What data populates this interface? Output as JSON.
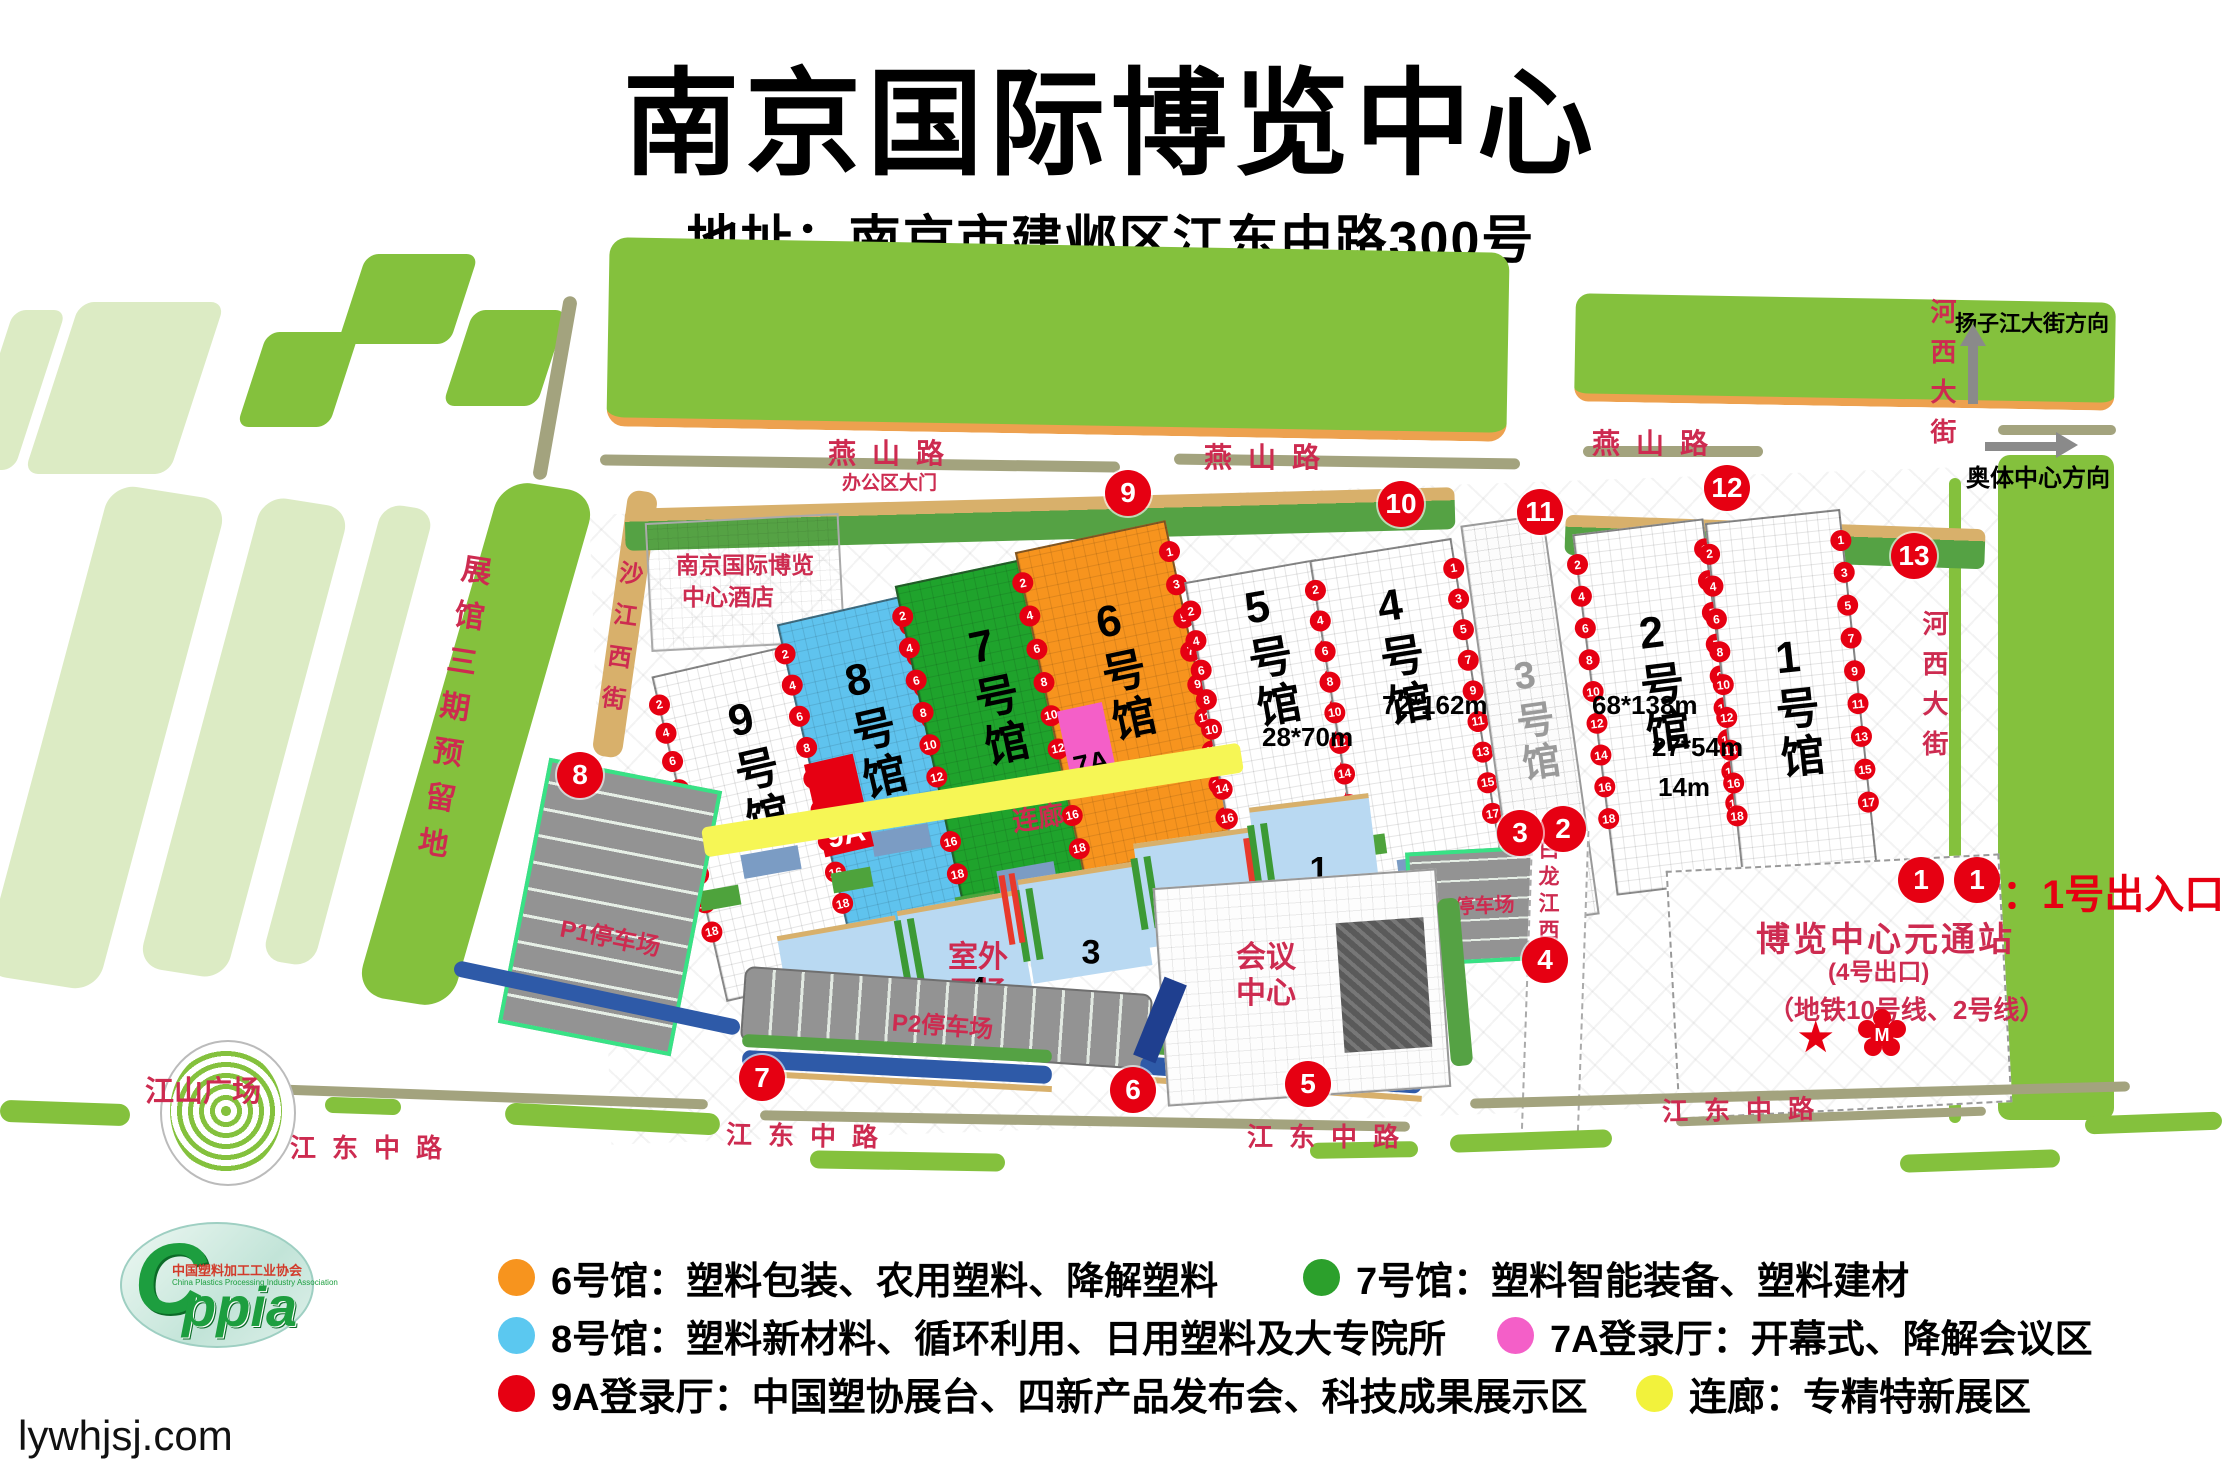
{
  "header": {
    "title": "南京国际博览中心",
    "address": "地址：南京市建邺区江东中路300号"
  },
  "watermark": "lywhjsj.com",
  "roads": {
    "yanshan": "燕山路",
    "jiangdong": "江东中路",
    "jinsha": "金沙江西街",
    "bailong": "白龙江西街",
    "hexi": "河西大街"
  },
  "directions": {
    "yangzijiang": "扬子江大街方向",
    "aoti": "奥体中心方向"
  },
  "places": {
    "reserved_strip": "展馆三期预留地",
    "hotel_line1": "南京国际博览",
    "hotel_line2": "中心酒店",
    "office_gate": "办公区大门",
    "jiangshan_square": "江山广场",
    "outdoor_line1": "室外",
    "outdoor_line2": "展场",
    "conference_line1": "会议",
    "conference_line2": "中心",
    "corridor": "连廊",
    "p1": "P1停车场",
    "p2": "P2停车场",
    "p3": "P3停车场",
    "station_name": "博览中心元通站",
    "station_exit": "(4号出口)",
    "station_lines": "（地铁10号线、2号线）",
    "entrance_marker": "1",
    "entrance_note": "：1号出入口"
  },
  "halls": [
    {
      "id": "9",
      "label": "9号馆",
      "color": "#ffffff"
    },
    {
      "id": "8",
      "label": "8号馆",
      "color": "#5fc3ee"
    },
    {
      "id": "7",
      "label": "7号馆",
      "color": "#1fa32c"
    },
    {
      "id": "6",
      "label": "6号馆",
      "color": "#f7941e"
    },
    {
      "id": "5",
      "label": "5号馆",
      "color": "#ffffff"
    },
    {
      "id": "4",
      "label": "4号馆",
      "color": "#ffffff"
    },
    {
      "id": "3",
      "label": "3号馆",
      "color": "#ffffff"
    },
    {
      "id": "2",
      "label": "2号馆",
      "color": "#ffffff"
    },
    {
      "id": "1",
      "label": "1号馆",
      "color": "#ffffff"
    },
    {
      "id": "9A",
      "label": "9A",
      "color": "#e60012"
    },
    {
      "id": "7A",
      "label": "7A",
      "color": "#f45fc8"
    }
  ],
  "dims": {
    "hall4": "72*162m",
    "hall5": "28*70m",
    "hall2": "68*138m",
    "hall1": "27*54m",
    "hall1b": "14m"
  },
  "outdoor_numbers": [
    "1",
    "2",
    "3",
    "4",
    "5"
  ],
  "markers": [
    "1",
    "2",
    "3",
    "4",
    "5",
    "6",
    "7",
    "8",
    "9",
    "10",
    "11",
    "12",
    "13"
  ],
  "gate_numbers": {
    "left": [
      "2",
      "4",
      "6",
      "8",
      "10",
      "12",
      "14",
      "16",
      "18"
    ],
    "right": [
      "1",
      "3",
      "5",
      "7",
      "9",
      "11",
      "13",
      "15",
      "17"
    ]
  },
  "legend": [
    {
      "color": "#f7941e",
      "text": "6号馆：塑料包装、农用塑料、降解塑料"
    },
    {
      "color": "#2ca02c",
      "text": "7号馆：塑料智能装备、塑料建材"
    },
    {
      "color": "#5bc8f0",
      "text": "8号馆：塑料新材料、循环利用、日用塑料及大专院所"
    },
    {
      "color": "#f45fc8",
      "text": "7A登录厅：开幕式、降解会议区"
    },
    {
      "color": "#e60012",
      "text": "9A登录厅：中国塑协展台、四新产品发布会、科技成果展示区"
    },
    {
      "color": "#f2f23c",
      "text": "连廊：专精特新展区"
    }
  ],
  "logo": {
    "big": "ppia",
    "cn": "中国塑料加工工业协会",
    "en": "China Plastics Processing Industry Association"
  }
}
